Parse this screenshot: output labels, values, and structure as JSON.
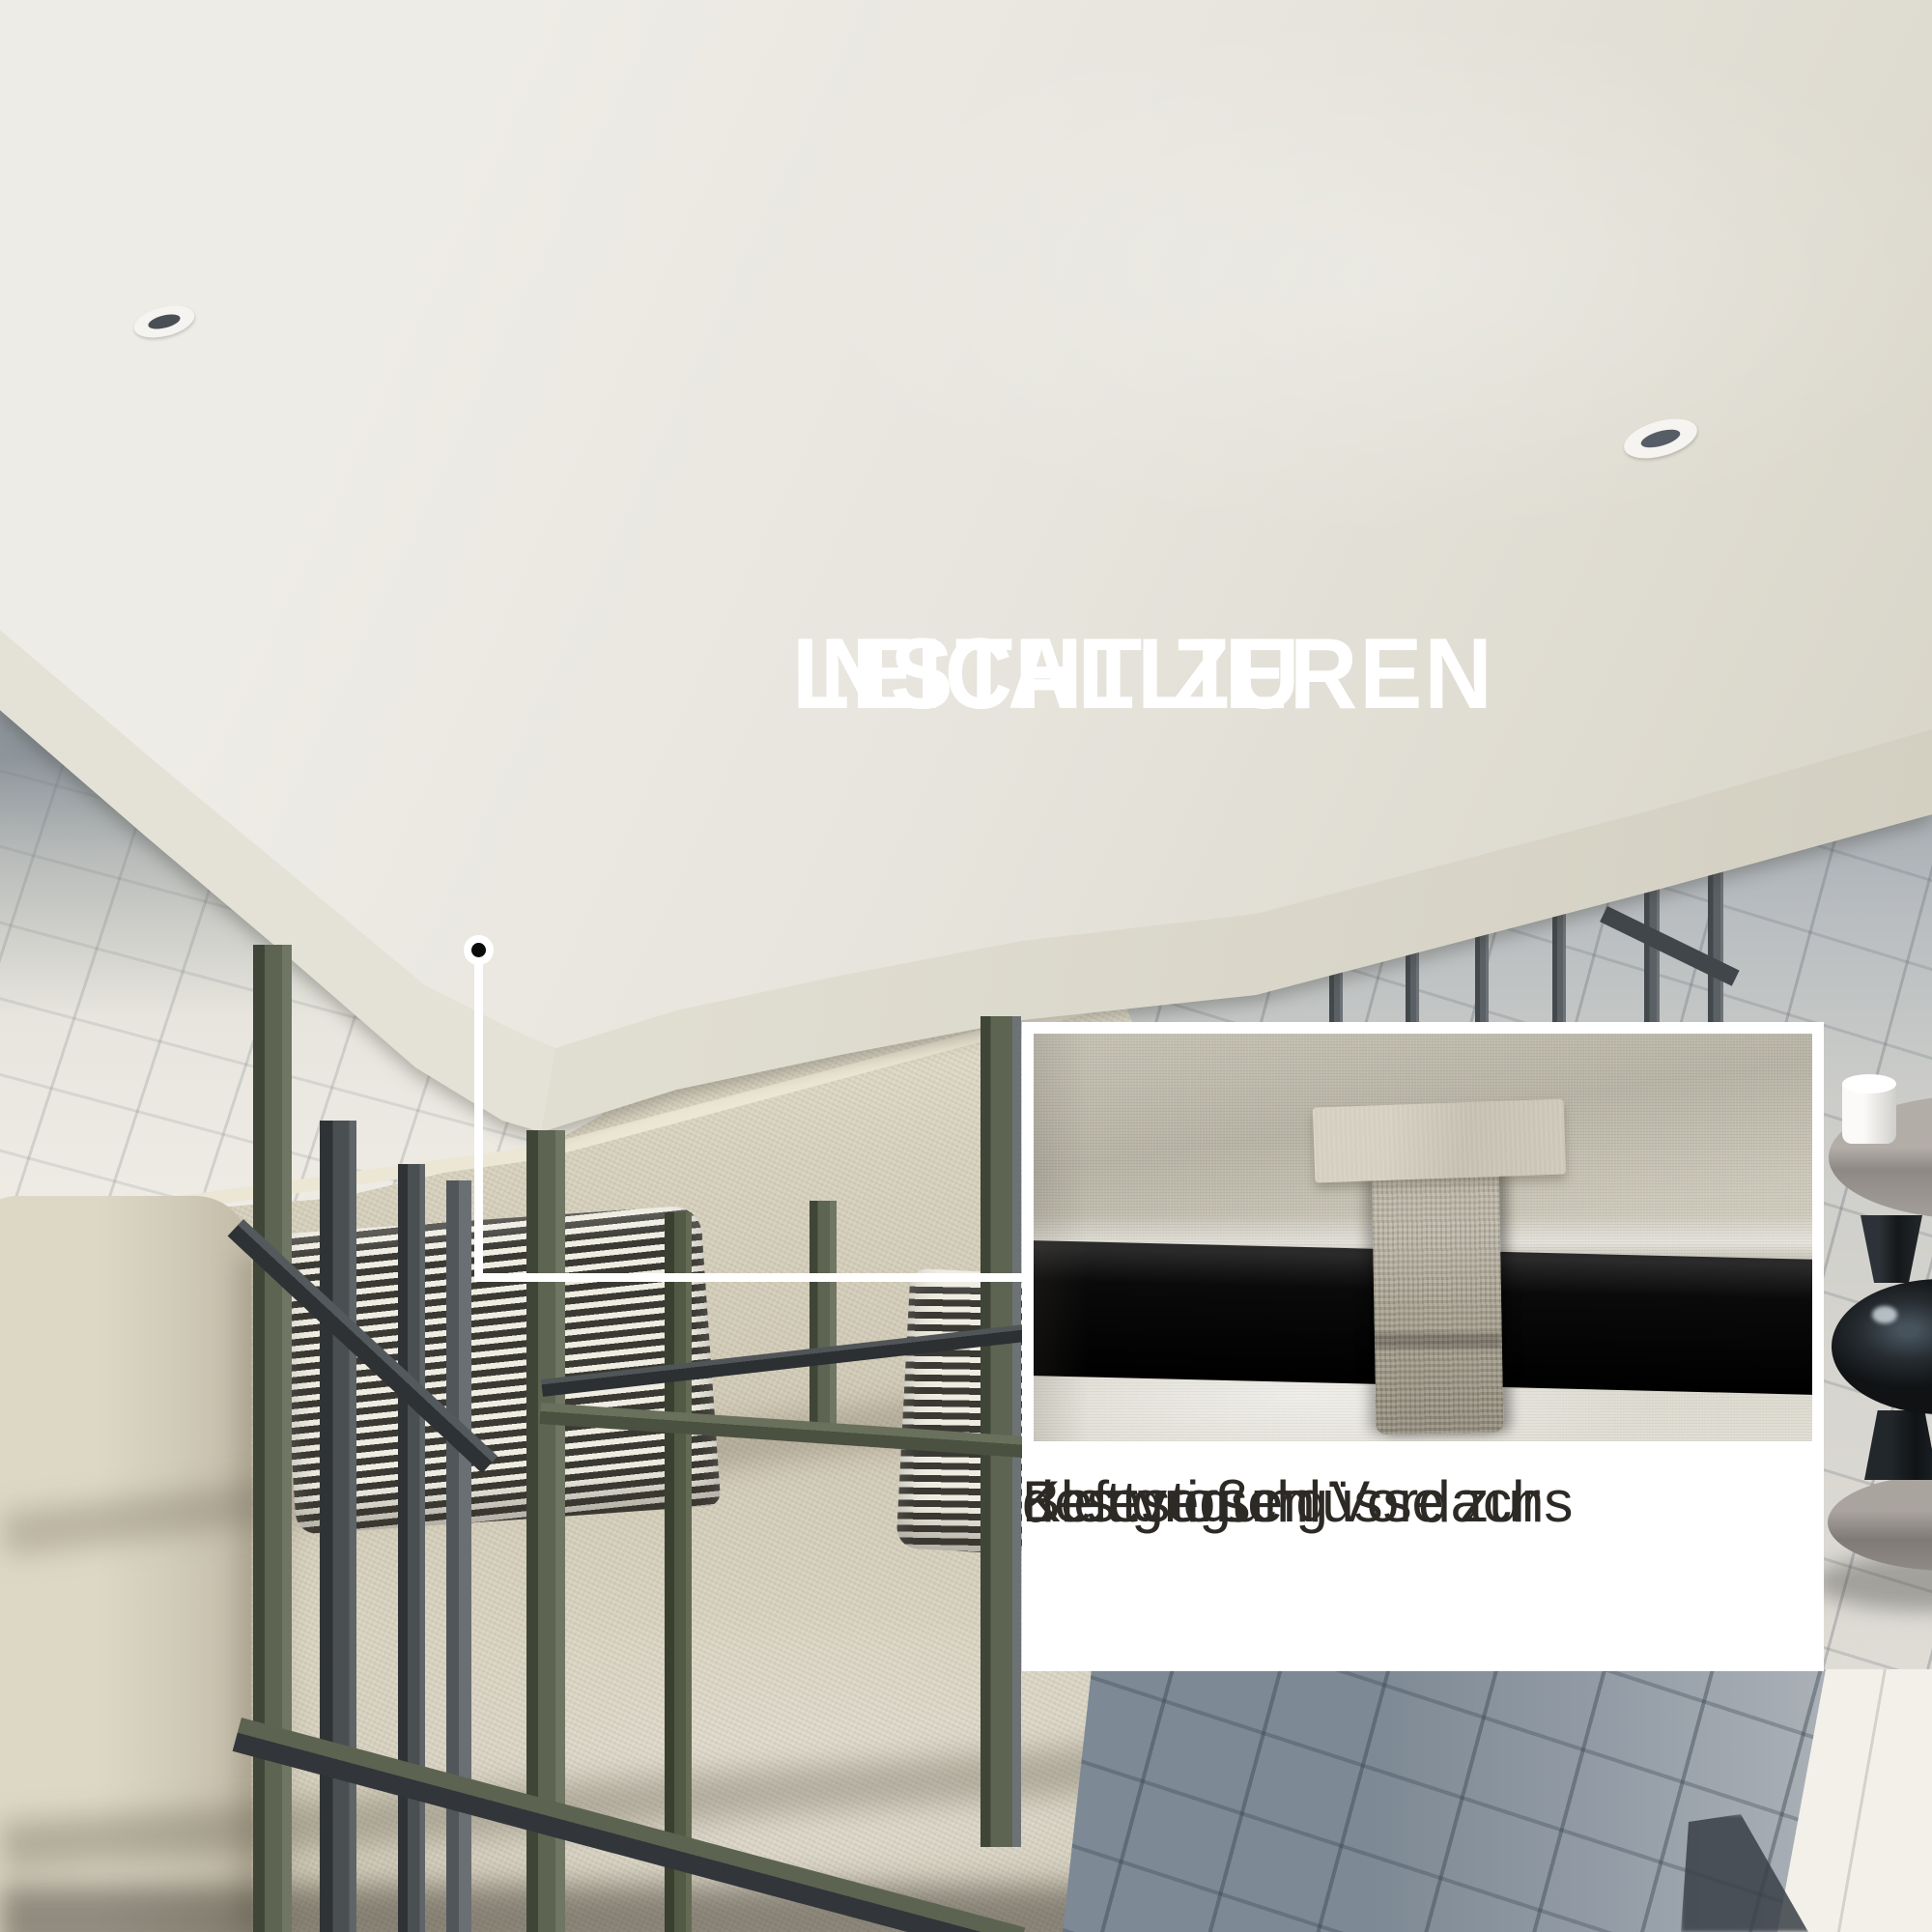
{
  "headline": {
    "lines": [
      "LEICHT ZU",
      "INSTALLIEREN"
    ],
    "color": "#ffffff"
  },
  "inset": {
    "caption_lines": [
      "Klettverschlüsse zur",
      "Befestigung",
      "des großen Vordachs"
    ],
    "caption_color": "#2d2a26",
    "panel_bg": "#ffffff",
    "photo_subject": "velcro-strap-around-black-frame-bar"
  },
  "callout": {
    "style": "dot-with-elbow-line",
    "color": "#ffffff"
  },
  "scene": {
    "subject": "gazebo-canopy-over-outdoor-sofa",
    "canopy_color": "#e7e5dd",
    "canopy_valance_color": "#d8d5c8",
    "frame_dark_color": "#3c4043",
    "frame_olive_color": "#5d6452",
    "sofa_fabric_color": "#d5cfbc",
    "pillow_stripe_dark": "#3a3933",
    "pillow_stripe_light": "#efece2",
    "paving_shadow_color": "#8a95a0",
    "paving_bright_color": "#f1efe7",
    "table_top_color": "#a19b96",
    "glass_decor_color": "#17191c",
    "grommet_count": 2
  }
}
